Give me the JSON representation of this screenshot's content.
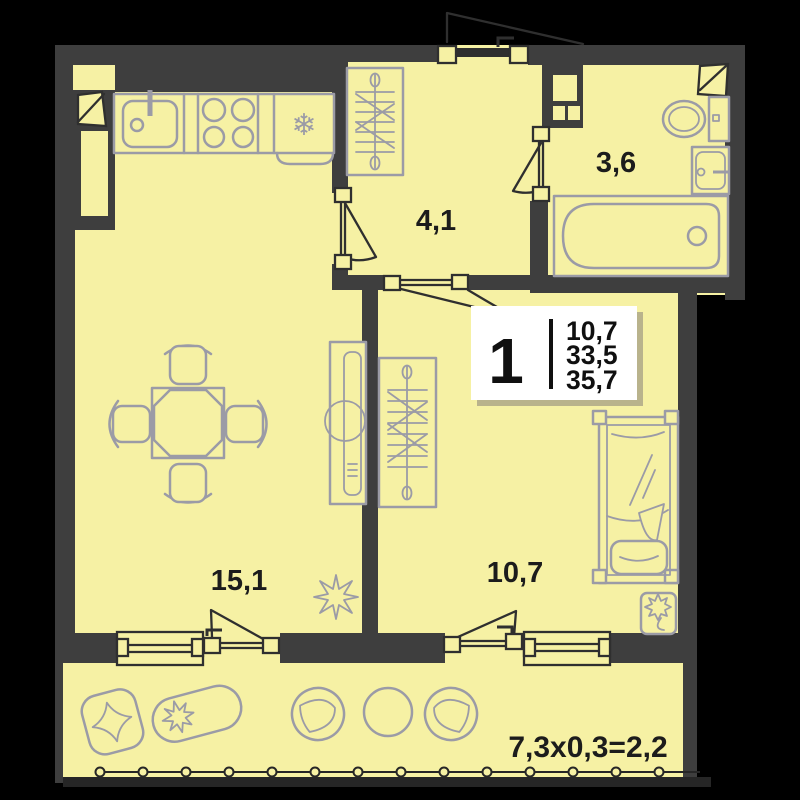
{
  "colors": {
    "background": "#000000",
    "room_fill": "#f6f1a4",
    "wall": "#3e3e3e",
    "furniture_line": "#9b9ba6",
    "door_line": "#2f2f2f",
    "label_text": "#1c1c1c",
    "card_bg": "#ffffff",
    "card_shadow": "#b9b38c",
    "card_text": "#101010"
  },
  "rooms": {
    "hallway": {
      "area": "4,1"
    },
    "bathroom": {
      "area": "3,6"
    },
    "living_kitchen": {
      "area": "15,1"
    },
    "bedroom": {
      "area": "10,7"
    }
  },
  "balcony": {
    "dimensions": "7,3x0,3=2,2"
  },
  "stats_card": {
    "rooms_count": "1",
    "values": [
      "10,7",
      "33,5",
      "35,7"
    ]
  },
  "icons": {
    "fridge_snowflake": "❄"
  }
}
